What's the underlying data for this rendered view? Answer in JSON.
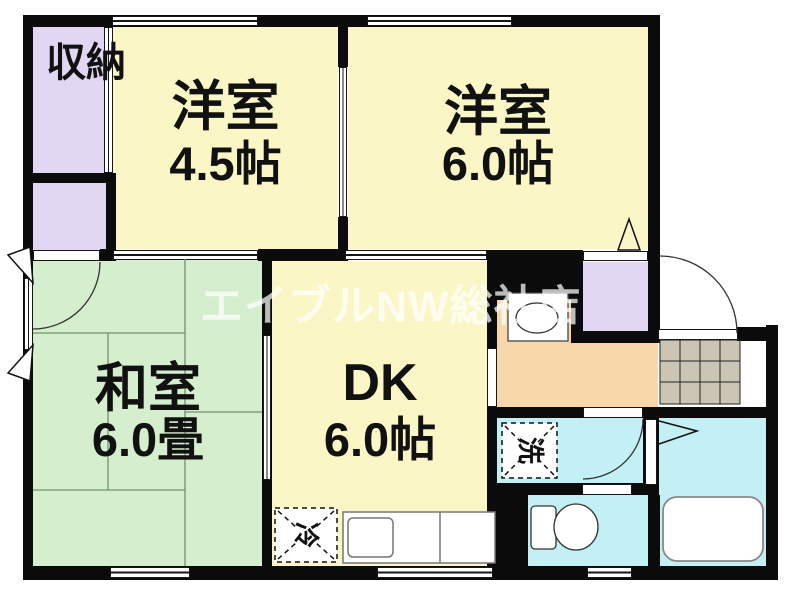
{
  "watermark": "エイブルNW総社店",
  "rooms": {
    "closet": {
      "label": "収納"
    },
    "western1": {
      "name": "洋室",
      "size": "4.5帖"
    },
    "western2": {
      "name": "洋室",
      "size": "6.0帖"
    },
    "japanese": {
      "name": "和室",
      "size": "6.0畳"
    },
    "dk": {
      "name": "DK",
      "size": "6.0帖"
    }
  },
  "fixtures": {
    "washing_machine": "洗",
    "refrigerator": "冷"
  },
  "colors": {
    "wall": "#0b0b0b",
    "room_yellow": "#faf6c6",
    "room_green": "#d5eecd",
    "closet_purple": "#e2d7f3",
    "kitchen_orange": "#f8d8ab",
    "wet_cyan": "#c3f0f4",
    "genkan_tile": "#cac5b4",
    "tatami_line": "#6f936f",
    "watermark_gray": "#bfbfbf"
  }
}
